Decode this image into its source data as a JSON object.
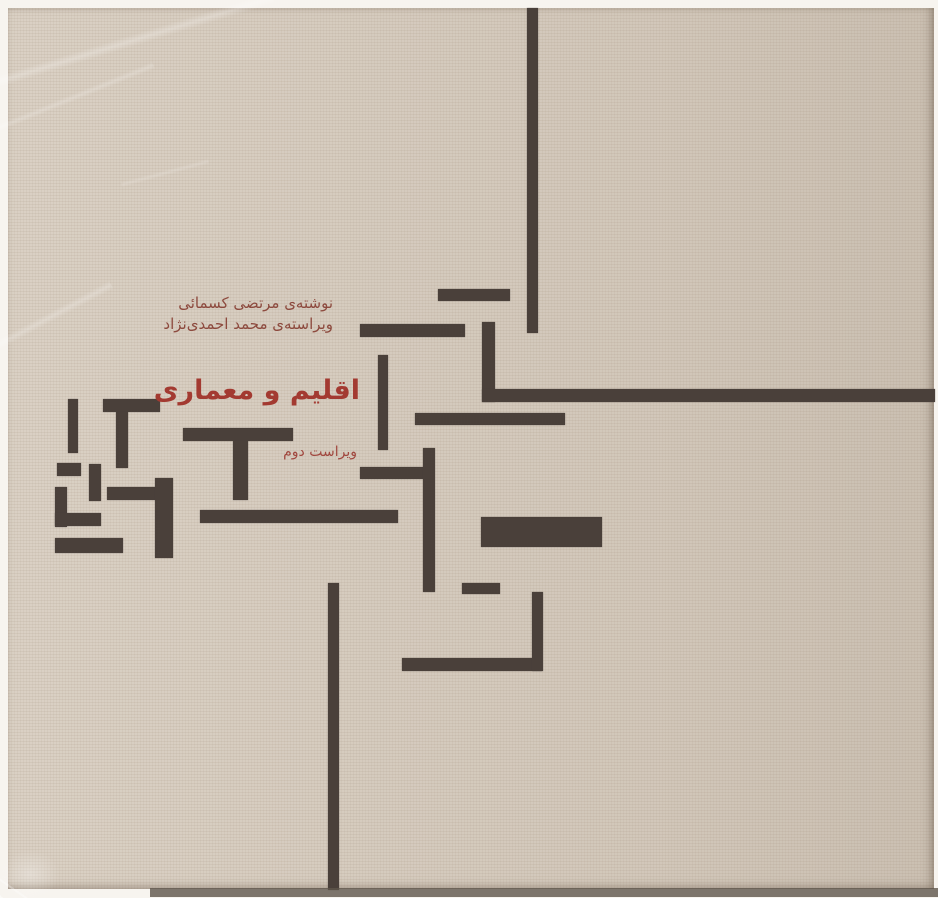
{
  "cover": {
    "author_line": "نوشته‌ی مرتضی کسمائی",
    "editor_line": "ویراسته‌ی محمد احمدی‌نژاد",
    "title": "اقلیم و معماری",
    "edition": "ویراست دوم"
  },
  "colors": {
    "background": "#d8cec1",
    "bar": "#4a403a",
    "title_red": "#a33a31",
    "byline_red": "#8d4a3e",
    "edition_red": "#a1483f"
  },
  "plan_bars": [
    {
      "x": 527,
      "y": 8,
      "w": 11,
      "h": 325
    },
    {
      "x": 438,
      "y": 289,
      "w": 72,
      "h": 12
    },
    {
      "x": 360,
      "y": 324,
      "w": 105,
      "h": 13
    },
    {
      "x": 482,
      "y": 322,
      "w": 13,
      "h": 80
    },
    {
      "x": 482,
      "y": 389,
      "w": 453,
      "h": 13
    },
    {
      "x": 415,
      "y": 413,
      "w": 150,
      "h": 12
    },
    {
      "x": 378,
      "y": 355,
      "w": 10,
      "h": 95
    },
    {
      "x": 68,
      "y": 399,
      "w": 10,
      "h": 54
    },
    {
      "x": 103,
      "y": 399,
      "w": 57,
      "h": 13
    },
    {
      "x": 116,
      "y": 412,
      "w": 12,
      "h": 56
    },
    {
      "x": 57,
      "y": 463,
      "w": 24,
      "h": 13
    },
    {
      "x": 55,
      "y": 487,
      "w": 12,
      "h": 40
    },
    {
      "x": 55,
      "y": 513,
      "w": 46,
      "h": 13
    },
    {
      "x": 89,
      "y": 464,
      "w": 12,
      "h": 37
    },
    {
      "x": 107,
      "y": 487,
      "w": 50,
      "h": 13
    },
    {
      "x": 155,
      "y": 478,
      "w": 18,
      "h": 80
    },
    {
      "x": 55,
      "y": 538,
      "w": 68,
      "h": 15
    },
    {
      "x": 183,
      "y": 428,
      "w": 110,
      "h": 13
    },
    {
      "x": 233,
      "y": 441,
      "w": 15,
      "h": 59
    },
    {
      "x": 200,
      "y": 510,
      "w": 198,
      "h": 13
    },
    {
      "x": 360,
      "y": 467,
      "w": 68,
      "h": 12
    },
    {
      "x": 423,
      "y": 448,
      "w": 12,
      "h": 144
    },
    {
      "x": 481,
      "y": 517,
      "w": 121,
      "h": 30
    },
    {
      "x": 462,
      "y": 583,
      "w": 38,
      "h": 11
    },
    {
      "x": 402,
      "y": 658,
      "w": 140,
      "h": 13
    },
    {
      "x": 532,
      "y": 592,
      "w": 11,
      "h": 79
    },
    {
      "x": 328,
      "y": 583,
      "w": 11,
      "h": 307
    }
  ]
}
